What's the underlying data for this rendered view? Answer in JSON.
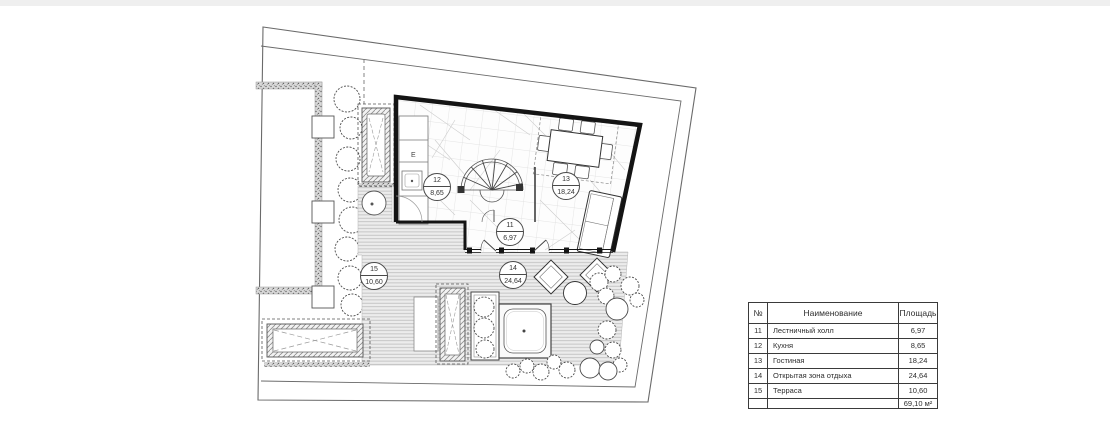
{
  "plan": {
    "room_labels": [
      {
        "number": "12",
        "area": "8,65"
      },
      {
        "number": "13",
        "area": "18,24"
      },
      {
        "number": "11",
        "area": "6,97"
      },
      {
        "number": "14",
        "area": "24,64"
      },
      {
        "number": "15",
        "area": "10,60"
      }
    ],
    "appliance_label": "E"
  },
  "legend_table": {
    "col_headers": {
      "num": "№",
      "name": "Наименование",
      "area": "Площадь"
    },
    "rows": [
      {
        "num": "11",
        "name": "Лестничный холл",
        "area": "6,97"
      },
      {
        "num": "12",
        "name": "Кухня",
        "area": "8,65"
      },
      {
        "num": "13",
        "name": "Гостиная",
        "area": "18,24"
      },
      {
        "num": "14",
        "name": "Открытая зона отдыха",
        "area": "24,64"
      },
      {
        "num": "15",
        "name": "Терраса",
        "area": "10,60"
      }
    ],
    "total_area": "69,10 м²"
  },
  "colors": {
    "wall": "#141414",
    "line": "#4a4a4a",
    "deck_line": "#bdbdbd",
    "paper": "#ffffff"
  }
}
